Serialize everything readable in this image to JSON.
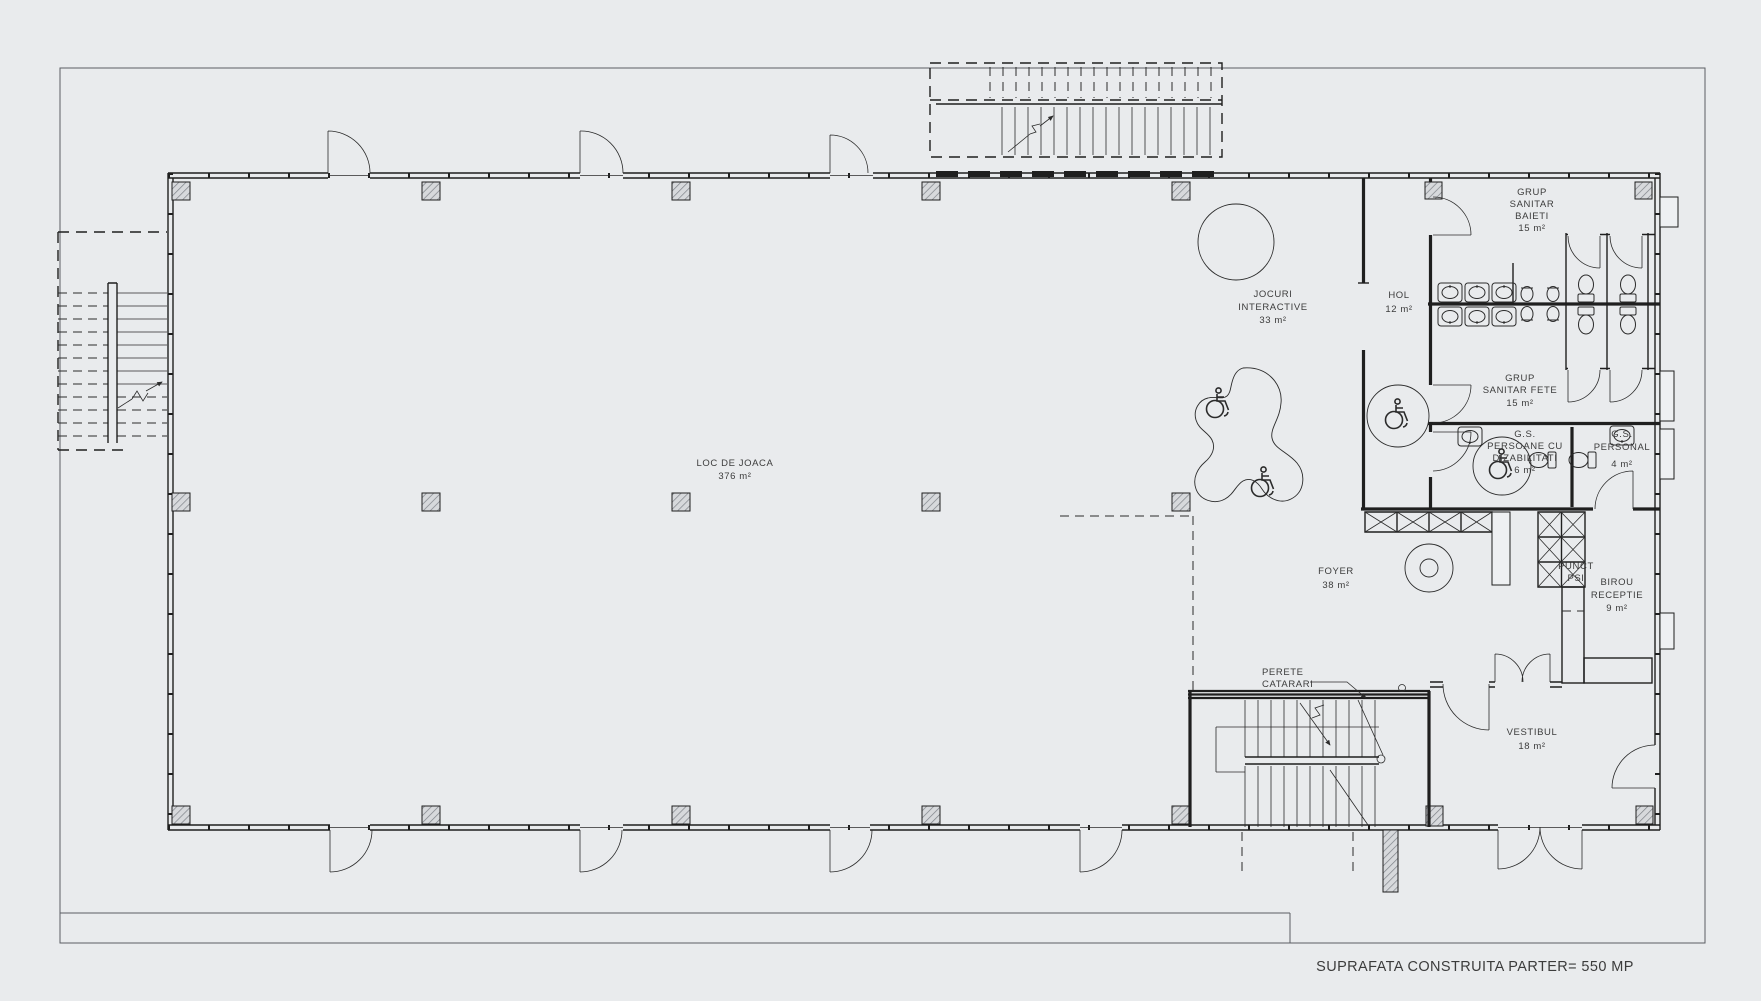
{
  "colors": {
    "background": "#e9ebed",
    "line": "#1f1f1f",
    "text": "#3c3c3c"
  },
  "icons": {
    "wheelchair-icon": "accessibility symbol (drawn shape)",
    "stair-arrow-icon": "direction arrow with break mark"
  },
  "rooms": {
    "loc_de_joaca": {
      "name": "LOC DE JOACA",
      "area": "376 m²"
    },
    "jocuri_interactive": {
      "line1": "JOCURI",
      "line2": "INTERACTIVE",
      "area": "33 m²"
    },
    "hol": {
      "name": "HOL",
      "area": "12 m²"
    },
    "grup_sanitar_baieti": {
      "line1": "GRUP",
      "line2": "SANITAR",
      "line3": "BAIETI",
      "area": "15 m²"
    },
    "grup_sanitar_fete": {
      "line1": "GRUP",
      "line2": "SANITAR FETE",
      "area": "15 m²"
    },
    "gs_dizabilitati": {
      "line1": "G.S.",
      "line2": "PERSOANE CU",
      "line3": "DIZABILITATI",
      "area": "6 m²"
    },
    "gs_personal": {
      "line1": "G.S.",
      "line2": "PERSONAL",
      "area": "4 m²"
    },
    "foyer": {
      "name": "FOYER",
      "area": "38 m²"
    },
    "punct_psi": {
      "line1": "PUNCT",
      "line2": "PSI"
    },
    "birou_receptie": {
      "line1": "BIROU",
      "line2": "RECEPTIE",
      "area": "9 m²"
    },
    "vestibul": {
      "name": "VESTIBUL",
      "area": "18 m²"
    }
  },
  "annotations": {
    "perete_catarari": {
      "line1": "PERETE",
      "line2": "CATARARI"
    }
  },
  "footer": {
    "title": "SUPRAFATA CONSTRUITA PARTER= 550 MP"
  }
}
